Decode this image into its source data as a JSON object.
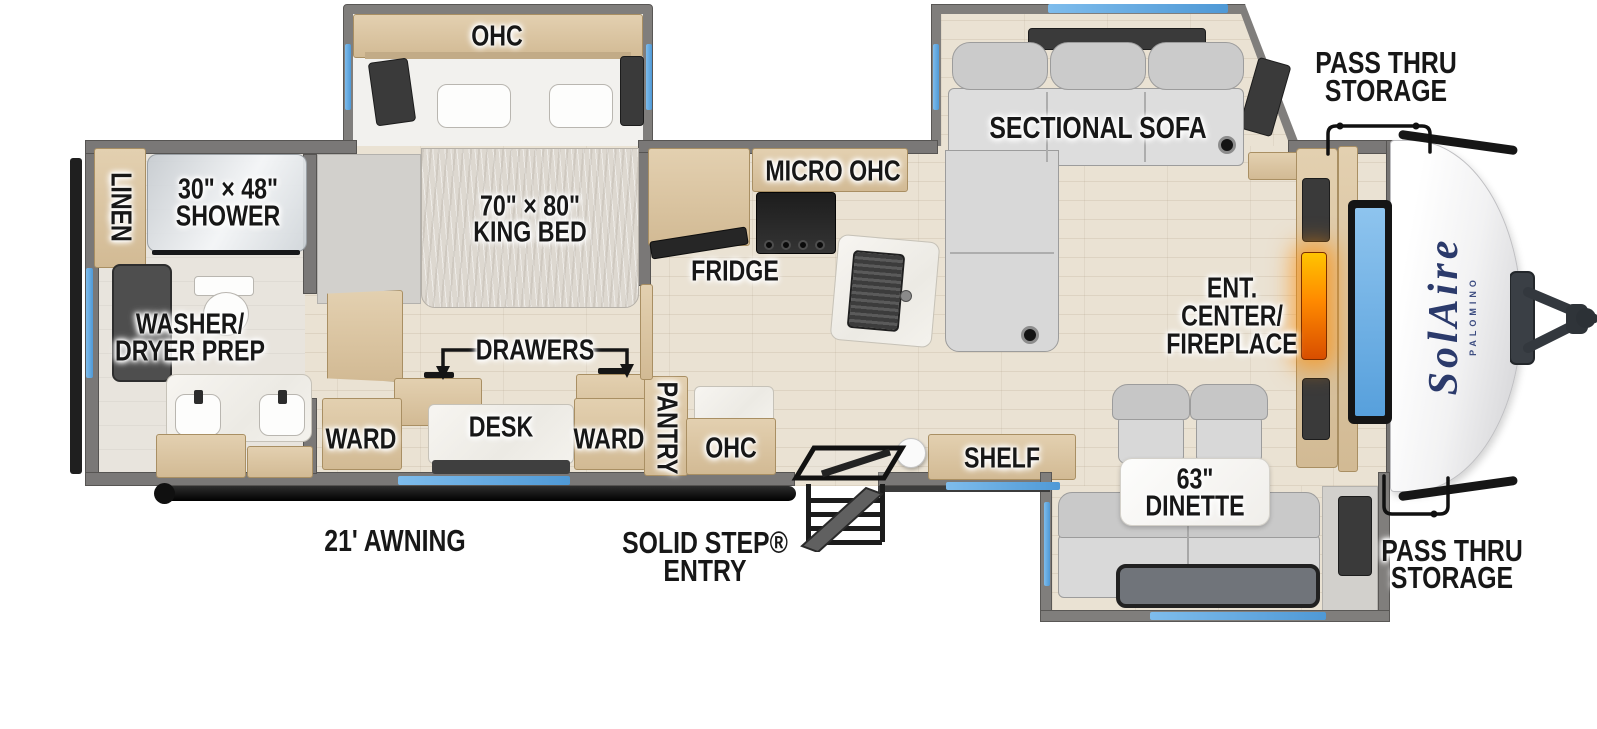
{
  "brand": {
    "name": "SolAire",
    "sub": "PALOMINO"
  },
  "exterior": {
    "pass_thru_top": {
      "line1": "PASS THRU",
      "line2": "STORAGE"
    },
    "pass_thru_bottom": {
      "line1": "PASS THRU",
      "line2": "STORAGE"
    },
    "awning": "21' AWNING",
    "solid_step": {
      "line1": "SOLID STEP®",
      "line2": "ENTRY"
    }
  },
  "bathroom": {
    "linen": "LINEN",
    "shower": {
      "line1": "30\" × 48\"",
      "line2": "SHOWER"
    },
    "washer_dryer": {
      "line1": "WASHER/",
      "line2": "DRYER PREP"
    }
  },
  "bedroom": {
    "ohc": "OHC",
    "king_bed": {
      "line1": "70\" × 80\"",
      "line2": "KING BED"
    },
    "drawers": "DRAWERS",
    "ward_left": "WARD",
    "desk": "DESK",
    "ward_right": "WARD"
  },
  "kitchen": {
    "micro_ohc": "MICRO  OHC",
    "fridge": "FRIDGE",
    "pantry": "PANTRY",
    "ohc": "OHC",
    "shelf": "SHELF"
  },
  "living": {
    "sofa": "SECTIONAL SOFA",
    "ent_center": {
      "line1": "ENT.",
      "line2": "CENTER/",
      "line3": "FIREPLACE"
    },
    "dinette": {
      "line1": "63\"",
      "line2": "DINETTE"
    }
  },
  "colors": {
    "wall_gray": "#7a7877",
    "floor_wood": "#eae2d3",
    "cabinet_tan": "#d8c3a5",
    "window_blue": "#62aade",
    "fireplace_orange": "#ff8a00",
    "fabric_gray": "#d0d0d0",
    "brand_navy": "#2b3a6b",
    "label_ink": "#171717"
  }
}
